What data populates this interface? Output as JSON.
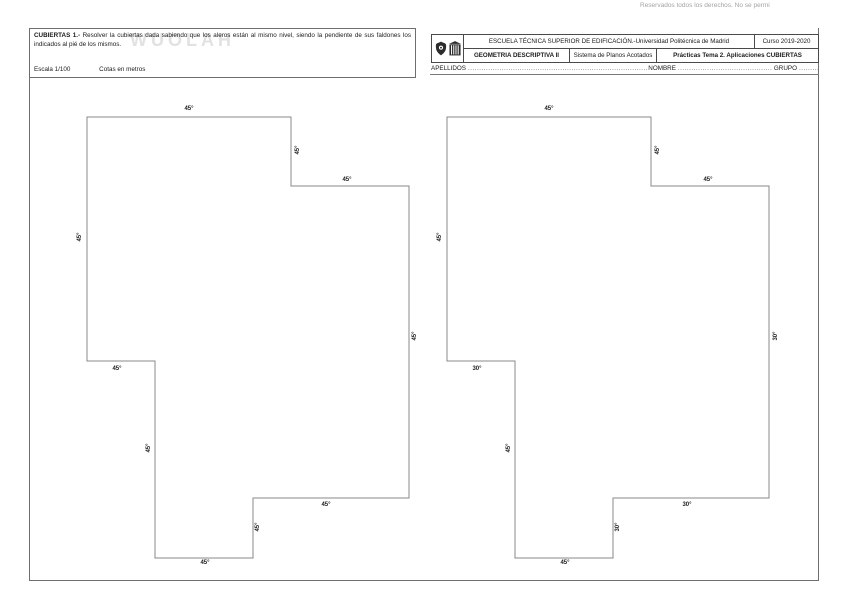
{
  "page": {
    "copyright_notice": "Reservados todos los derechos. No se permi",
    "watermark": "WUOLAH"
  },
  "task_box": {
    "title": "CUBIERTAS 1.-",
    "statement": " Resolver la cubiertas dada sabiendo que los aleros están al mismo nivel, siendo la pendiente de sus faldones los indicados al pié de los mismos.",
    "scale": "Escala 1/100",
    "units": "Cotas en metros"
  },
  "header": {
    "school": "ESCUELA TÉCNICA SUPERIOR DE EDIFICACIÓN.-Universidad Politécnica de Madrid",
    "course": "Curso 2019-2020",
    "subject": "GEOMETRIA DESCRIPTIVA II",
    "system": "Sistema de Planos Acotados",
    "topic": "Prácticas Tema 2. Aplicaciones CUBIERTAS",
    "fields": {
      "surname_label": "APELLIDOS",
      "surname_dots": "........................................................................................................................",
      "name_label": "NOMBRE",
      "name_dots": "................................................................",
      "group_label": "GRUPO",
      "group_dots": "..............."
    }
  },
  "drawings": {
    "left_roof": {
      "slope_labels": [
        "45°",
        "45°",
        "45°",
        "45°",
        "45°",
        "45°",
        "45°",
        "45°",
        "45°",
        "45°"
      ]
    },
    "right_roof": {
      "slope_labels": [
        "45°",
        "45°",
        "45°",
        "30°",
        "30°",
        "30°",
        "45°",
        "45°",
        "30°",
        "45°"
      ]
    }
  },
  "colors": {
    "outline": "#8a8a8a",
    "frame": "#6e6e6e",
    "table_border": "#4a4a4a",
    "text": "#1a1a1a",
    "muted": "#a3a3a3",
    "watermark": "#e2e2e2"
  }
}
